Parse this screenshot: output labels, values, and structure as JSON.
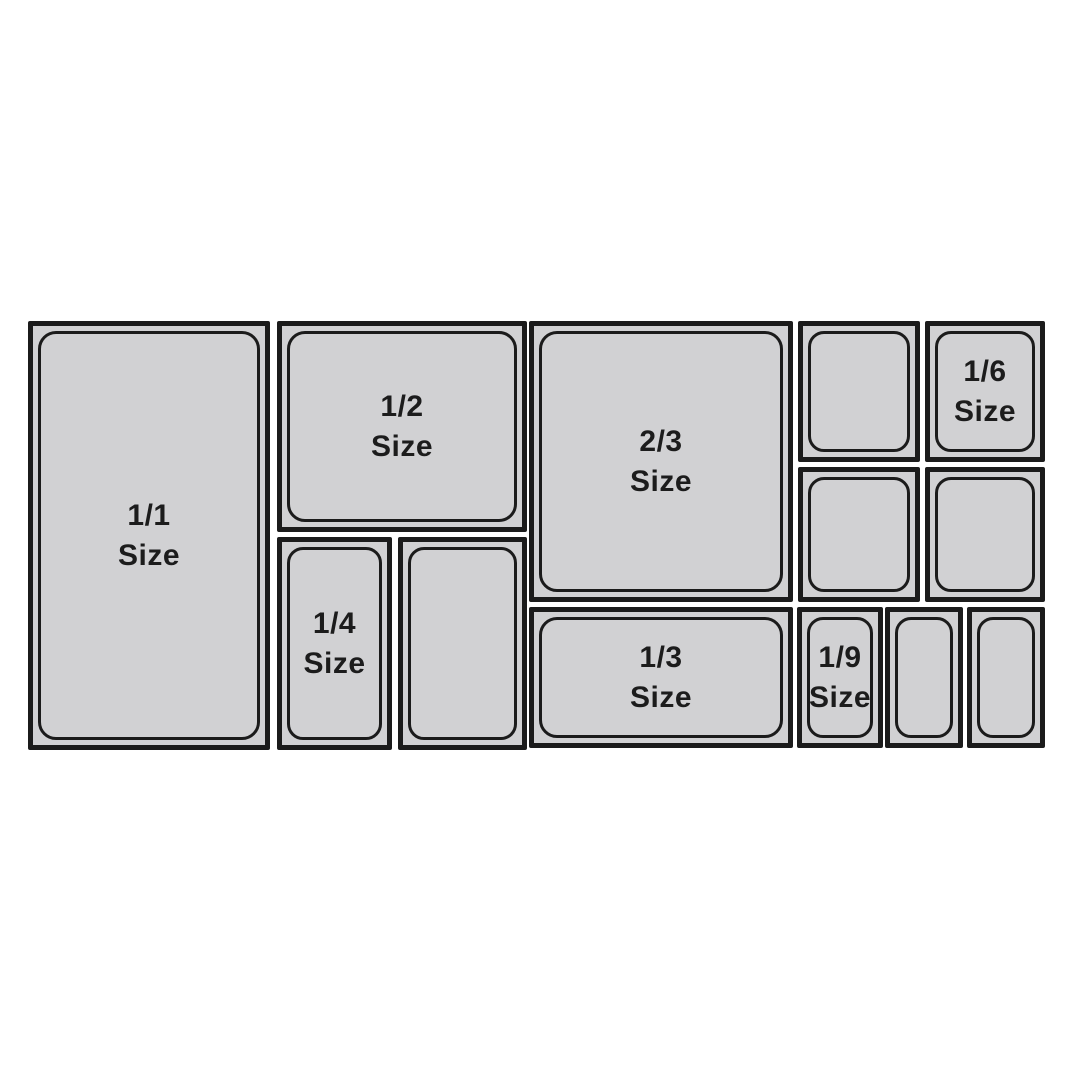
{
  "colors": {
    "background": "#ffffff",
    "pan_fill": "#d1d1d3",
    "pan_line": "#1b1b1b",
    "label_text": "#1c1c1c"
  },
  "diagram": {
    "description": "pan size layout",
    "pans": [
      {
        "name": "pan-1-1",
        "fraction": "1/1",
        "word": "Size"
      },
      {
        "name": "pan-1-2",
        "fraction": "1/2",
        "word": "Size"
      },
      {
        "name": "pan-1-4",
        "fraction": "1/4",
        "word": "Size"
      },
      {
        "name": "pan-quarter-unlabeled",
        "fraction": "",
        "word": ""
      },
      {
        "name": "pan-2-3",
        "fraction": "2/3",
        "word": "Size"
      },
      {
        "name": "pan-1-3",
        "fraction": "1/3",
        "word": "Size"
      },
      {
        "name": "pan-sixth-unlabeled-top",
        "fraction": "",
        "word": ""
      },
      {
        "name": "pan-1-6",
        "fraction": "1/6",
        "word": "Size"
      },
      {
        "name": "pan-sixth-unlabeled-left",
        "fraction": "",
        "word": ""
      },
      {
        "name": "pan-sixth-unlabeled-right",
        "fraction": "",
        "word": ""
      },
      {
        "name": "pan-1-9",
        "fraction": "1/9",
        "word": "Size"
      },
      {
        "name": "pan-ninth-unlabeled-mid",
        "fraction": "",
        "word": ""
      },
      {
        "name": "pan-ninth-unlabeled-right",
        "fraction": "",
        "word": ""
      }
    ]
  }
}
